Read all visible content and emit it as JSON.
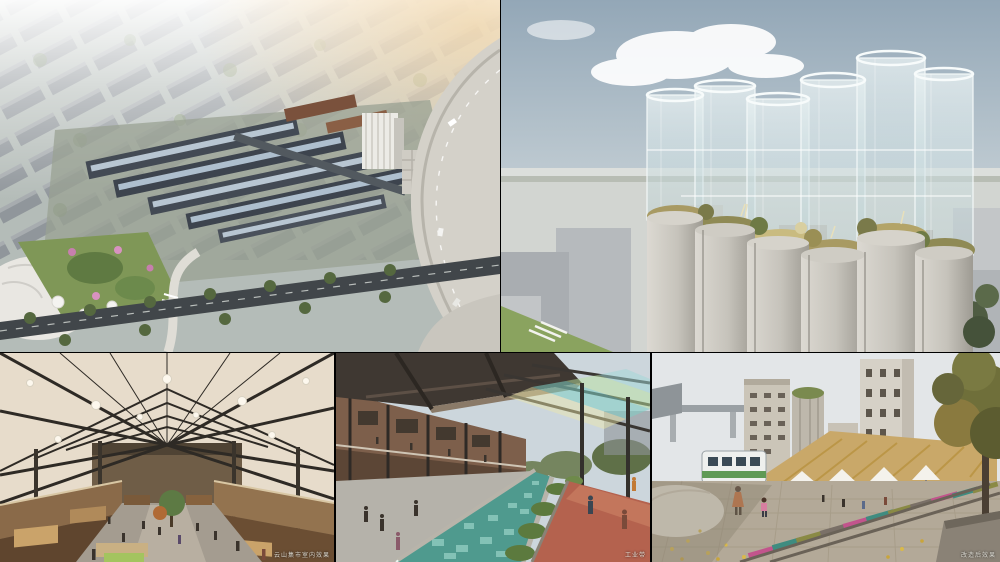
{
  "collage": {
    "title": "Architectural rendering collage — industrial heritage regeneration project",
    "background_color": "#000000",
    "layout": {
      "top_row_panels": 2,
      "bottom_row_panels": 3
    },
    "panels": [
      {
        "name": "masterplan-aerial",
        "alt": "Aerial rendering of a factory campus masterplan: long sawtooth-roof industrial halls with blue skylights, white silo building, surrounding gray city blocks, park with pink blossom trees, and a curved elevated highway ramp on the right",
        "caption": "",
        "palette": {
          "sky_haze": "#e9ece9",
          "blocks": "#8e9499",
          "hall_roof": "#434a54",
          "skylight": "#b8c6d2",
          "park_green": "#7f9757",
          "blossom_pink": "#c77fae",
          "highway": "#d4d1c9"
        }
      },
      {
        "name": "silo-towers",
        "alt": "Rendering of a cluster of concrete grain silos topped with transparent glass cylinders and a golden rooftop garden, hazy skyline behind and gray massing buildings below",
        "caption": "",
        "palette": {
          "sky_top": "#93a7b7",
          "sky_low": "#d3dadd",
          "concrete": "#c6c3bb",
          "glass": "#d7e8ea",
          "planting": "#a89a63"
        }
      },
      {
        "name": "market-hall-interior",
        "alt": "Interior rendering of a timber-and-steel market hall with translucent gabled roof, hexagonal lights, wooden mezzanines, stalls, a central tree and visitors",
        "caption": "云山集市室内效果",
        "palette": {
          "roof_glow": "#e7dccb",
          "frame": "#2e2a25",
          "wood": "#8a6a49",
          "floor": "#a49c90"
        }
      },
      {
        "name": "canal-promenade",
        "alt": "Rendering of a promenade along a glass-tiled water channel, brick arcade buildings and dark canopy on the left, steel pergola with teal and green glass panels over a terracotta walkway on the right",
        "caption": "工业带",
        "palette": {
          "canopy": "#3f3832",
          "brick": "#7d5f4b",
          "water_glass": "#4f9a8e",
          "terracotta": "#b4624e",
          "pergola_glass": "#7fd0c4"
        }
      },
      {
        "name": "railway-plaza",
        "alt": "Rendering of a plaza with preserved railway tracks and pink, teal and olive painted sleepers, cobblestones with fallen ginkgo leaves, a retro train car, thatched-roof brick warehouse with white umbrellas, tall silo mill towers behind and a large autumn tree on the right",
        "caption": "改造后效果",
        "palette": {
          "sky": "#e3e6e8",
          "thatch": "#c9a869",
          "brick": "#9a6a50",
          "sleeper_pink": "#c2548c",
          "sleeper_teal": "#3f8c80",
          "leaves": "#d9b94a"
        }
      }
    ]
  }
}
